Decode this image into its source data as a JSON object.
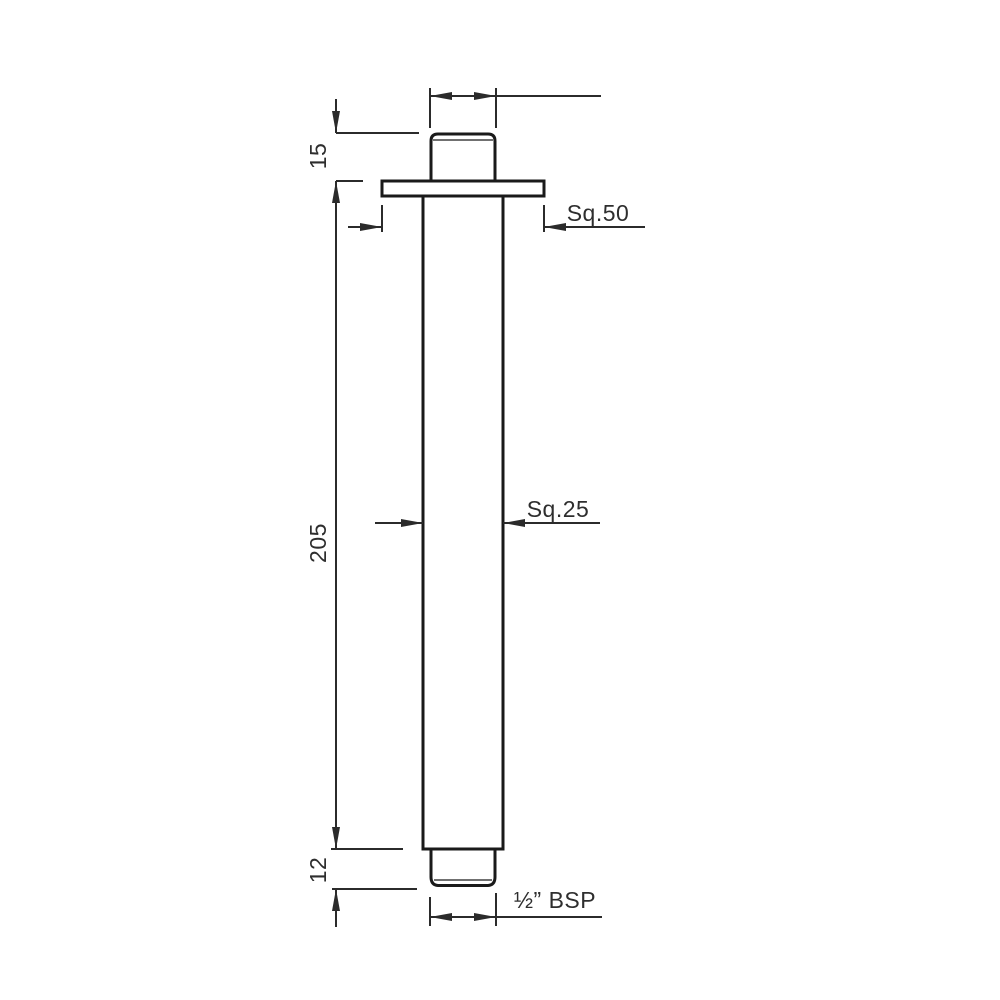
{
  "drawing": {
    "colors": {
      "background": "#ffffff",
      "outline": "#1a1a1a",
      "dimension_lines": "#2b2b2b",
      "text": "#2e2e2e"
    },
    "labels": {
      "dim_15": "15",
      "dim_205": "205",
      "dim_12": "12",
      "dim_sq50": "Sq.50",
      "dim_sq25": "Sq.25",
      "dim_bsp": "½” BSP"
    },
    "dimensions": [
      {
        "label": "15",
        "measures": "top-thread-height",
        "orientation": "vertical"
      },
      {
        "label": "205",
        "measures": "arm-tube-length",
        "orientation": "vertical"
      },
      {
        "label": "12",
        "measures": "bottom-thread-height",
        "orientation": "vertical"
      },
      {
        "label": "Sq.50",
        "measures": "flange-width",
        "orientation": "horizontal"
      },
      {
        "label": "Sq.25",
        "measures": "arm-tube-width",
        "orientation": "horizontal"
      },
      {
        "label": "½” BSP",
        "measures": "thread-size",
        "orientation": "horizontal"
      }
    ]
  }
}
